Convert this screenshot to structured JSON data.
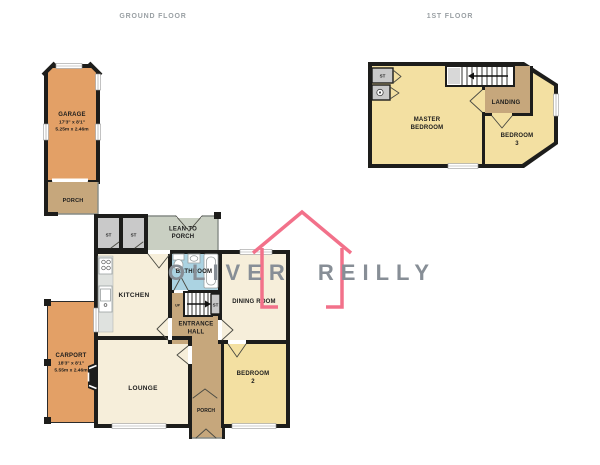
{
  "floors": {
    "ground": {
      "title": "GROUND FLOOR"
    },
    "first": {
      "title": "1ST FLOOR"
    }
  },
  "rooms": {
    "garage": {
      "name": "GARAGE",
      "dims_ft": "17'3\" x 8'1\"",
      "dims_m": "5.25m x 2.46m"
    },
    "garage_porch": {
      "name": "PORCH"
    },
    "lean_to_porch": {
      "line1": "LEAN-TO",
      "line2": "PORCH"
    },
    "kitchen": {
      "name": "KITCHEN"
    },
    "bathroom": {
      "name": "BATHROOM"
    },
    "dining_room": {
      "name": "DINING ROOM"
    },
    "entrance_hall": {
      "line1": "ENTRANCE",
      "line2": "HALL"
    },
    "lounge": {
      "name": "LOUNGE"
    },
    "front_porch": {
      "name": "PORCH"
    },
    "bedroom_2": {
      "line1": "BEDROOM",
      "line2": "2"
    },
    "carport": {
      "name": "CARPORT",
      "dims_ft": "18'3\" x 8'1\"",
      "dims_m": "5.55m x 2.46m"
    },
    "master_bedroom": {
      "line1": "MASTER",
      "line2": "BEDROOM"
    },
    "landing": {
      "name": "LANDING"
    },
    "bedroom_3": {
      "line1": "BEDROOM",
      "line2": "3"
    }
  },
  "labels": {
    "storage": "ST",
    "up": "UP"
  },
  "watermark": {
    "text": "OLIVER REILLY"
  },
  "colors": {
    "outbuilding": "#e3a066",
    "hall": "#c6a77c",
    "lean_to": "#c9cfc2",
    "living": "#f6eeda",
    "bedroom": "#f3e0a2",
    "bathroom": "#abd3e2",
    "closet": "#c9c9c9",
    "floor_title": "#9aa0a4",
    "watermark_house": "#f2718a",
    "watermark_text": "#878e96"
  }
}
